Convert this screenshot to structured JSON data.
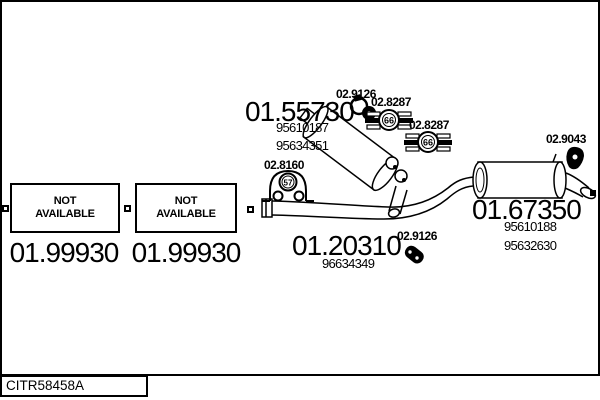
{
  "drawing_code": "CITR58458A",
  "colors": {
    "ink": "#000000",
    "paper": "#ffffff"
  },
  "na_boxes": [
    {
      "line1": "NOT",
      "line2": "AVAILABLE",
      "number": "01.99930"
    },
    {
      "line1": "NOT",
      "line2": "AVAILABLE",
      "number": "01.99930"
    }
  ],
  "parts": {
    "middle_silencer": {
      "number": "01.55730",
      "oe_refs": [
        "95610187",
        "95634351"
      ]
    },
    "front_pipe": {
      "number": "01.20310",
      "oe_refs": [
        "96634349"
      ]
    },
    "rear_silencer": {
      "number": "01.67350",
      "oe_refs": [
        "95610188",
        "95632630"
      ]
    }
  },
  "accessories": {
    "clamp_top": {
      "number": "02.9126"
    },
    "hanger_upper": {
      "number": "02.8287",
      "type_code": "66"
    },
    "hanger_lower": {
      "number": "02.8287",
      "type_code": "66"
    },
    "mount": {
      "number": "02.8160",
      "type_code": "57"
    },
    "grommet": {
      "number": "02.9043"
    },
    "clamp_bottom": {
      "number": "02.9126"
    }
  }
}
